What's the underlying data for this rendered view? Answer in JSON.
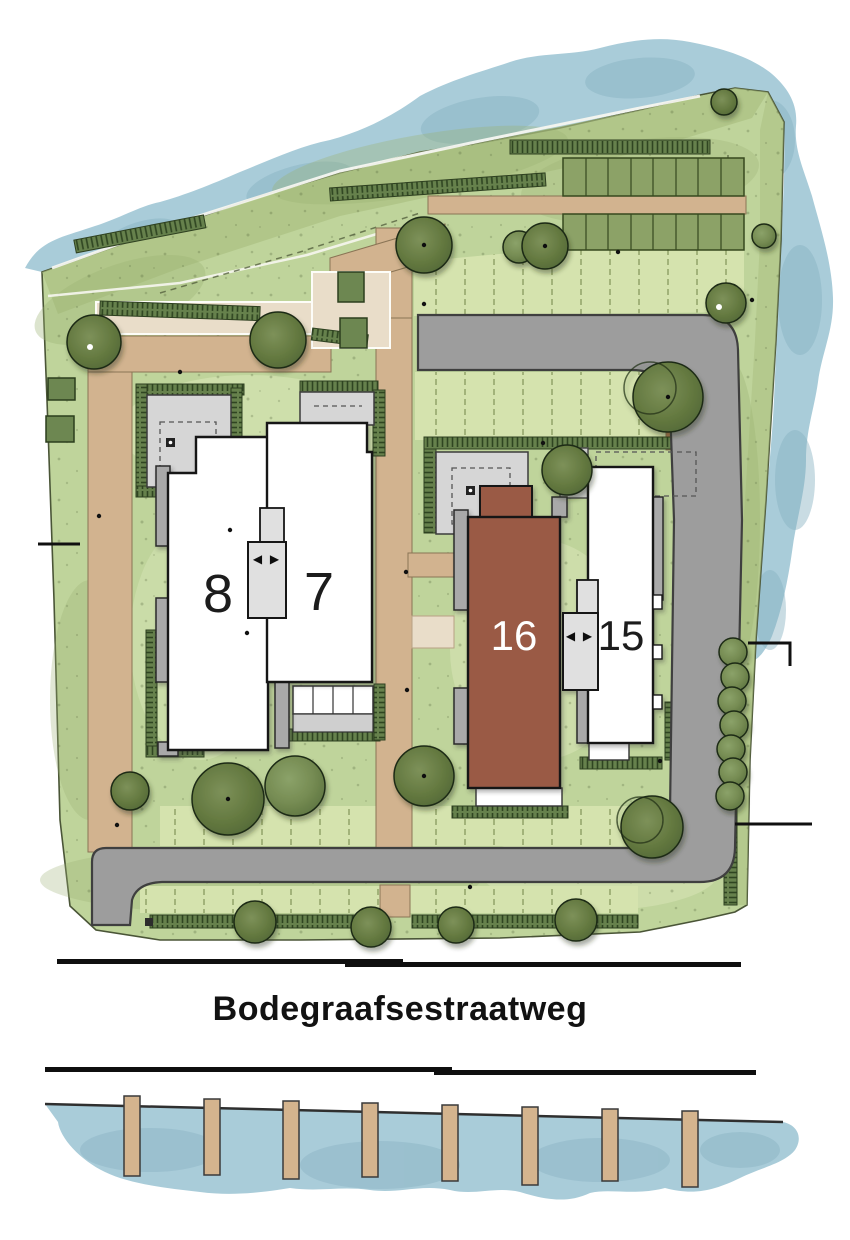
{
  "site_plan": {
    "street": {
      "name": "Bodegraafsestraatweg"
    },
    "buildings": [
      {
        "number": "8",
        "fill": "#ffffff"
      },
      {
        "number": "7",
        "fill": "#ffffff"
      },
      {
        "number": "16",
        "fill": "#9a5a44"
      },
      {
        "number": "15",
        "fill": "#ffffff"
      }
    ],
    "connector_arrows": "◀ ▶",
    "water": {
      "pier_count": 8
    },
    "parking": {
      "rows": 2
    },
    "colors": {
      "water": "#a9ccd9",
      "grass": "#bfd49b",
      "grass_light": "#d5e3ae",
      "bank": "#a9be80",
      "hedge": "#66814c",
      "hedge_line": "#2f4521",
      "road": "#9d9d9d",
      "path_tan": "#d2b38f",
      "beige": "#e9ddc9",
      "building_accent": "#9a5a44",
      "building_white": "#ffffff",
      "connector_gray": "#e0e0e0",
      "wing_gray": "#a9a9a9",
      "terrace_gray": "#d6d6d6",
      "tree_green": "#7d935c",
      "pier_tan": "#d4b48e",
      "ink": "#1c1c1c"
    }
  }
}
